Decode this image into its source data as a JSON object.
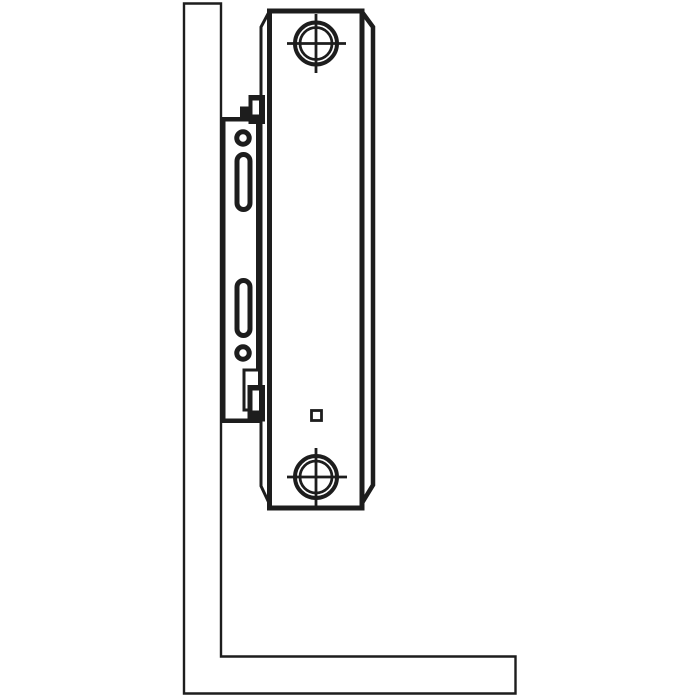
{
  "colors": {
    "background": "#ffffff",
    "surface": "#ffffff",
    "line": "#1d1d1d",
    "hatch_line": "#383838"
  },
  "diagram": {
    "type": "technical-line-drawing",
    "description": "Side-view installation diagram of a steel panel radiator hung on a wall mounting bracket above the floor",
    "components": {
      "wall": {
        "label": "wall cross-section",
        "fill_pattern": "diagonal-hatch-45deg"
      },
      "floor": {
        "label": "floor cross-section",
        "fill_pattern": "diagonal-hatch-45deg"
      },
      "bracket": {
        "label": "wall mounting bracket",
        "features": [
          "upper fixing hole",
          "upper vertical slot",
          "lower vertical slot",
          "lower fixing hole",
          "upper retaining hook",
          "lower retaining hook",
          "lower adjustment window"
        ]
      },
      "radiator": {
        "label": "panel radiator side profile",
        "features": [
          "top pipe connection boss with center-mark crosshair",
          "bottom pipe connection boss with center-mark crosshair",
          "small square marker"
        ]
      }
    }
  }
}
